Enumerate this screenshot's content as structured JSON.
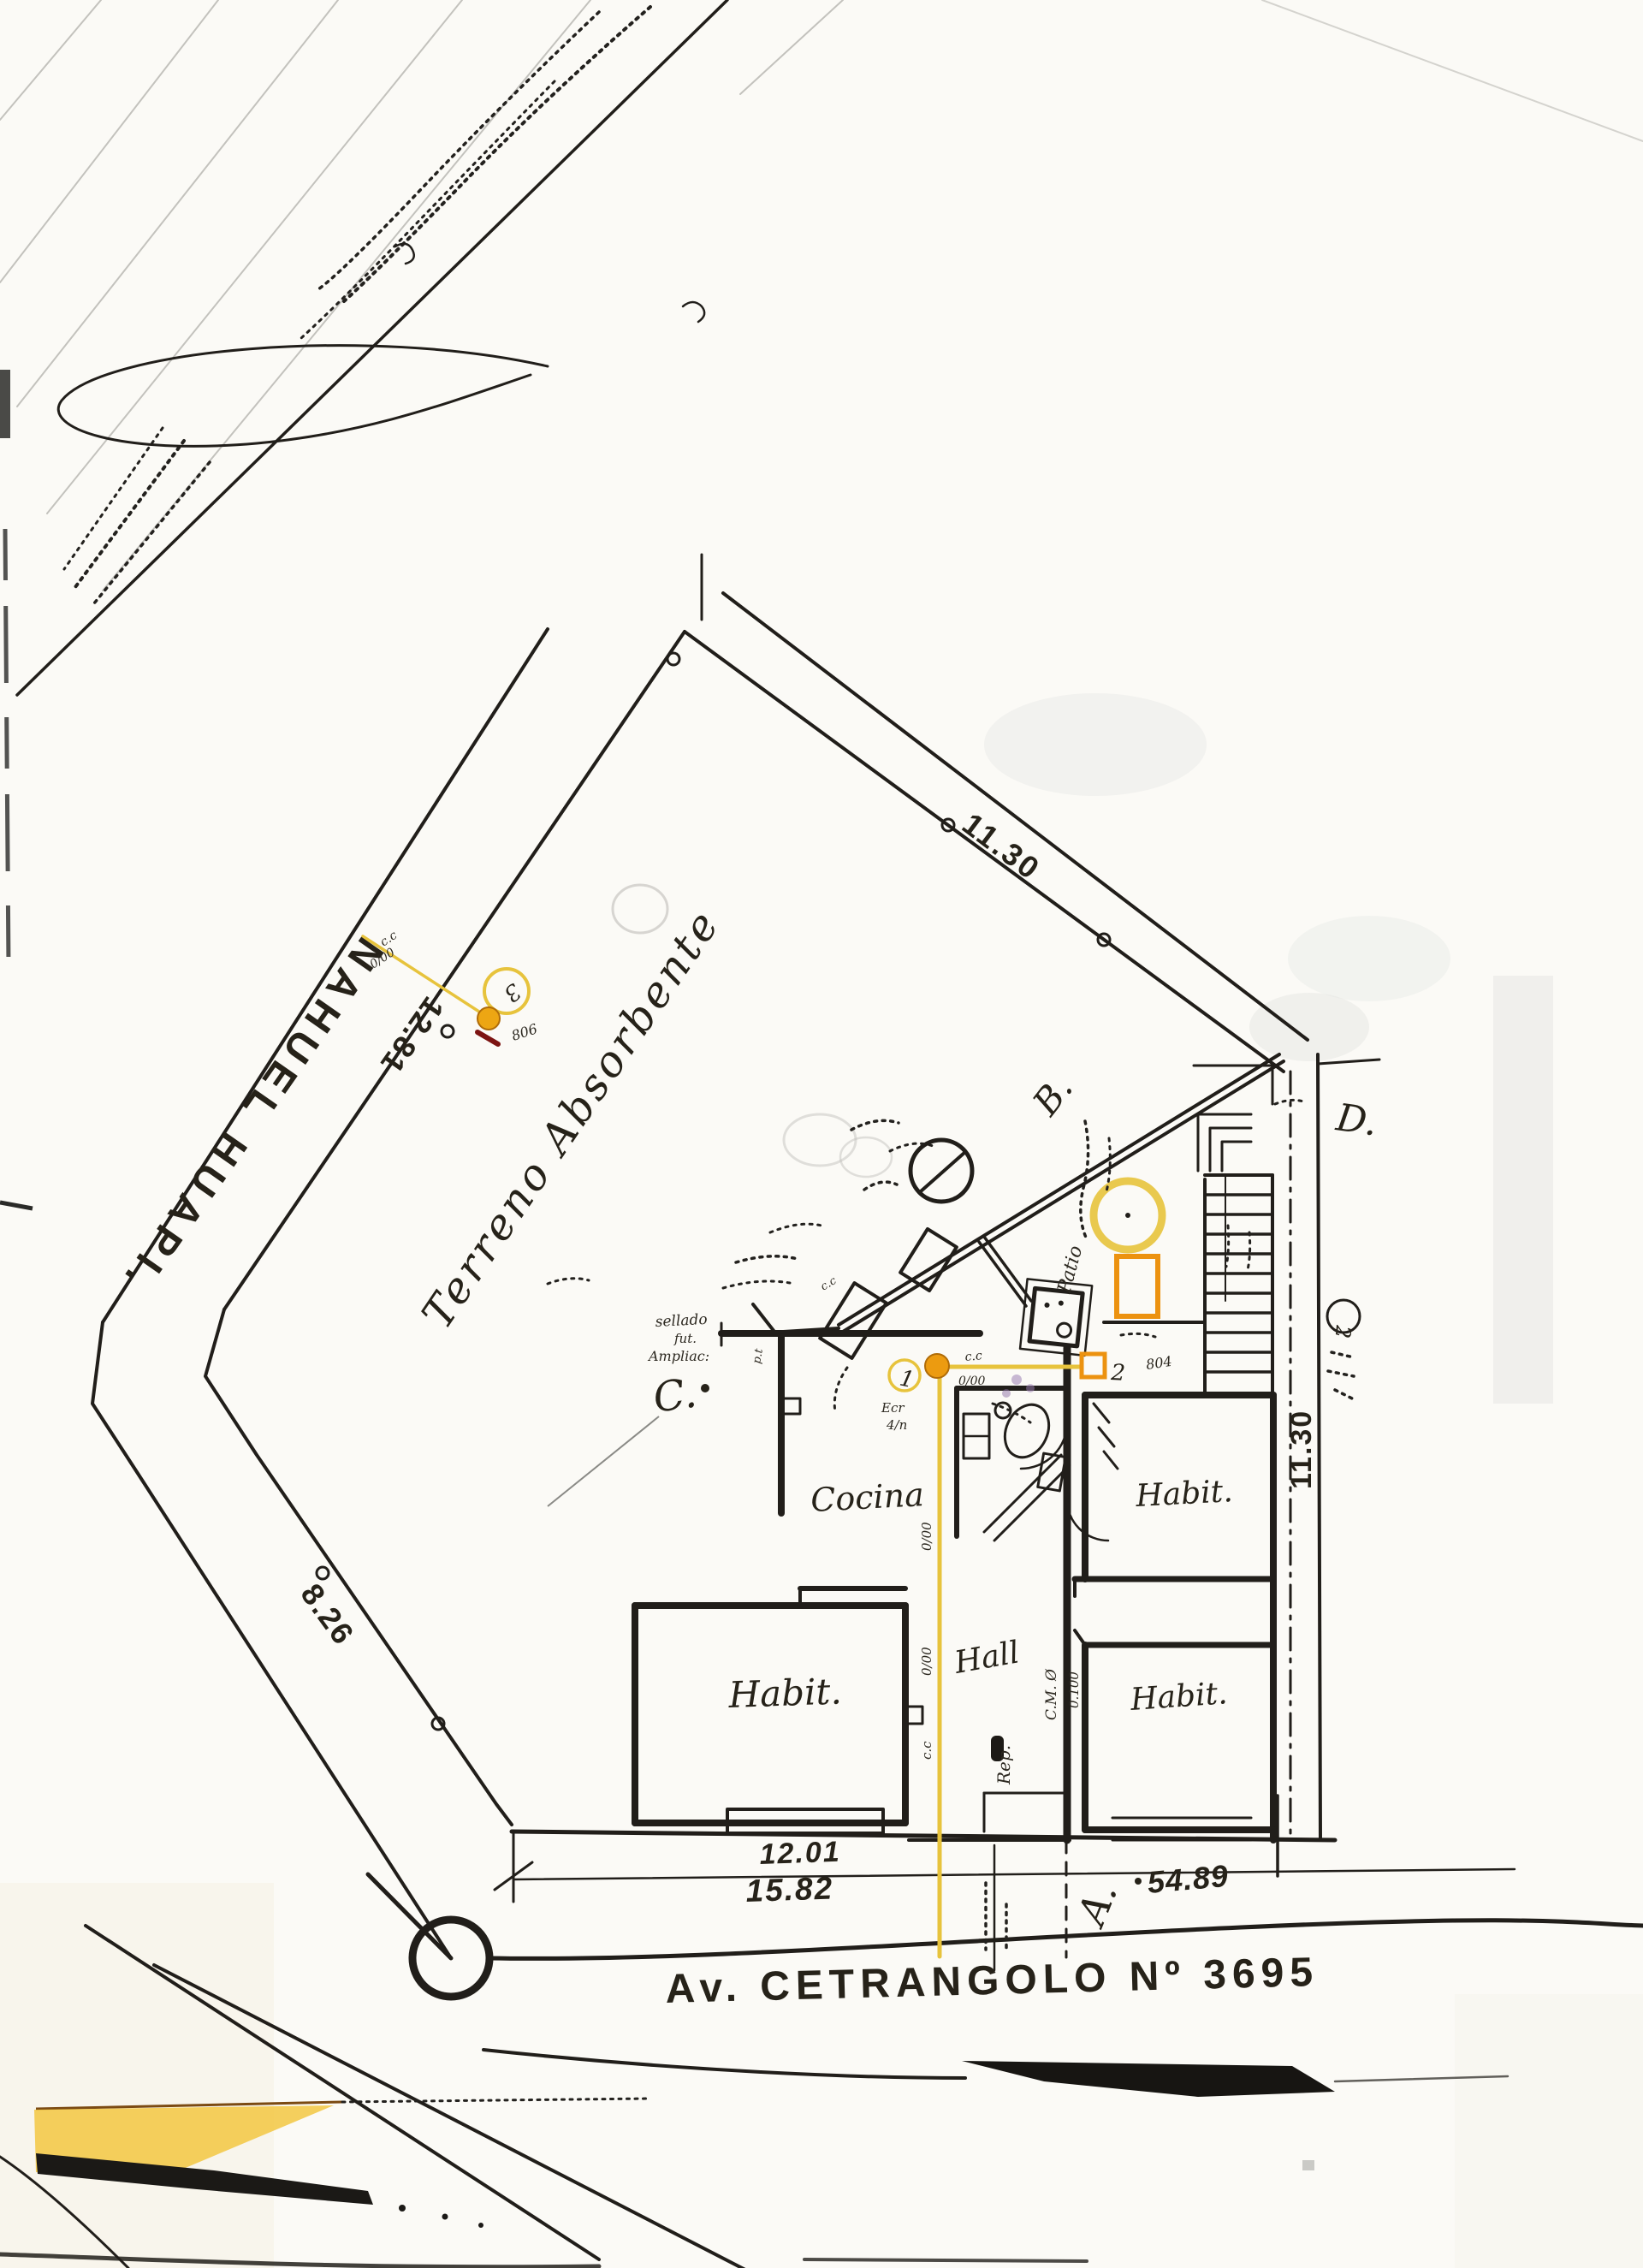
{
  "labels": {
    "street_left": "NAHUEL  HUAPI.",
    "street_bottom": "Av. CETRANGOLO Nº 3695",
    "terreno": "Terreno  Absorbente",
    "corner_a": "A.",
    "corner_b": "B.",
    "corner_c": "C.",
    "corner_d": "D."
  },
  "dims": {
    "top": "11.30",
    "right": "11.30",
    "nw": "12.81",
    "sw": "8.26",
    "front_a": "12.01",
    "front_b": "15.82",
    "front_c": "54.89"
  },
  "rooms": {
    "kitchen": "Cocina",
    "habit": "Habit.",
    "hall": "Hall",
    "rep": "Rep.",
    "patio": "Patio"
  },
  "points": {
    "p1_id": "1",
    "p1_note1": "Ecr",
    "p1_note2": "4/n",
    "p2_id": "2",
    "p2_elev": "804",
    "p3_id": "3",
    "p3_elev": "806",
    "p2r_id": "2"
  },
  "ann": {
    "cc": "c.c",
    "zz": "0/00",
    "cm": "C.M. Ø",
    "cmv": "0.100",
    "pt": "p.t",
    "s1": "sellado",
    "s2": "fut.",
    "s3": "Ampliac:"
  }
}
